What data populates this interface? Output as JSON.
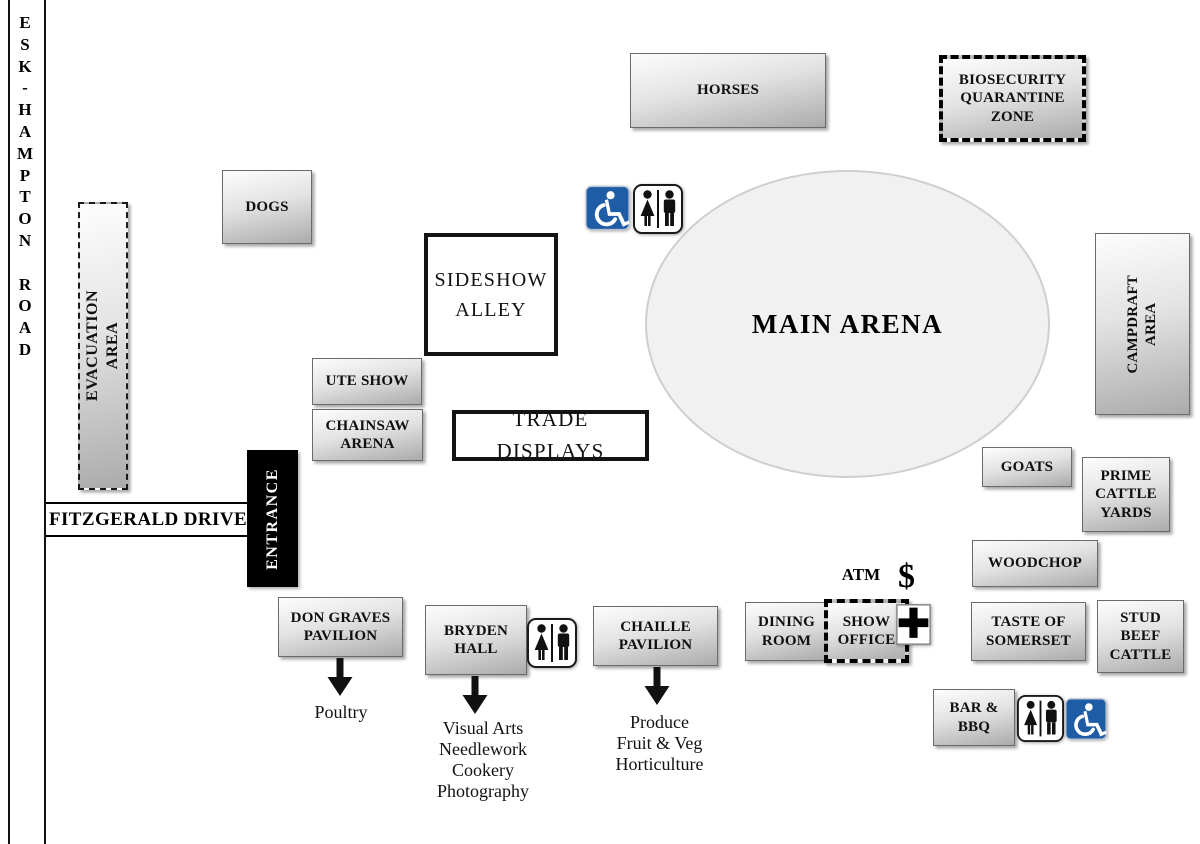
{
  "roads": {
    "esk_hampton_vertical": "E\nS\nK\n-\nH\nA\nM\nP\nT\nO\nN\n\nR\nO\nA\nD",
    "fitzgerald": "FITZGERALD DRIVE"
  },
  "zones": {
    "horses": "HORSES",
    "dogs": "DOGS",
    "evacuation_area": "EVACUATION AREA",
    "biosecurity": "BIOSECURITY\nQUARANTINE\nZONE",
    "main_arena": "MAIN ARENA",
    "sideshow_alley": "SIDESHOW\nALLEY",
    "ute_show": "UTE SHOW",
    "chainsaw_arena": "CHAINSAW\nARENA",
    "trade_displays": "TRADE DISPLAYS",
    "campdraft_area": "CAMPDRAFT\nAREA",
    "goats": "GOATS",
    "prime_cattle_yards": "PRIME\nCATTLE\nYARDS",
    "woodchop": "WOODCHOP",
    "entrance": "ENTRANCE",
    "don_graves_pavilion": "DON GRAVES\nPAVILION",
    "bryden_hall": "BRYDEN\nHALL",
    "chaille_pavilion": "CHAILLE\nPAVILION",
    "dining_room": "DINING\nROOM",
    "show_office": "SHOW\nOFFICE",
    "taste_of_somerset": "TASTE OF\nSOMERSET",
    "stud_beef_cattle": "STUD\nBEEF\nCATTLE",
    "bar_bbq": "BAR &\nBBQ"
  },
  "annotations": {
    "atm": "ATM",
    "dollar": "$",
    "poultry": "Poultry",
    "bryden_contents": "Visual Arts\nNeedlework\nCookery\nPhotography",
    "chaille_contents": "Produce\nFruit & Veg\nHorticulture"
  },
  "icons": {
    "accessible": "wheelchair-accessible-icon",
    "toilets": "toilets-icon",
    "first_aid": "first-aid-cross-icon",
    "arrow": "down-arrow-icon"
  },
  "colors": {
    "accessible_blue": "#1e5ca6",
    "box_border": "#6b6b6b",
    "arena_fill": "#f1f1f1",
    "ink": "#000000"
  }
}
